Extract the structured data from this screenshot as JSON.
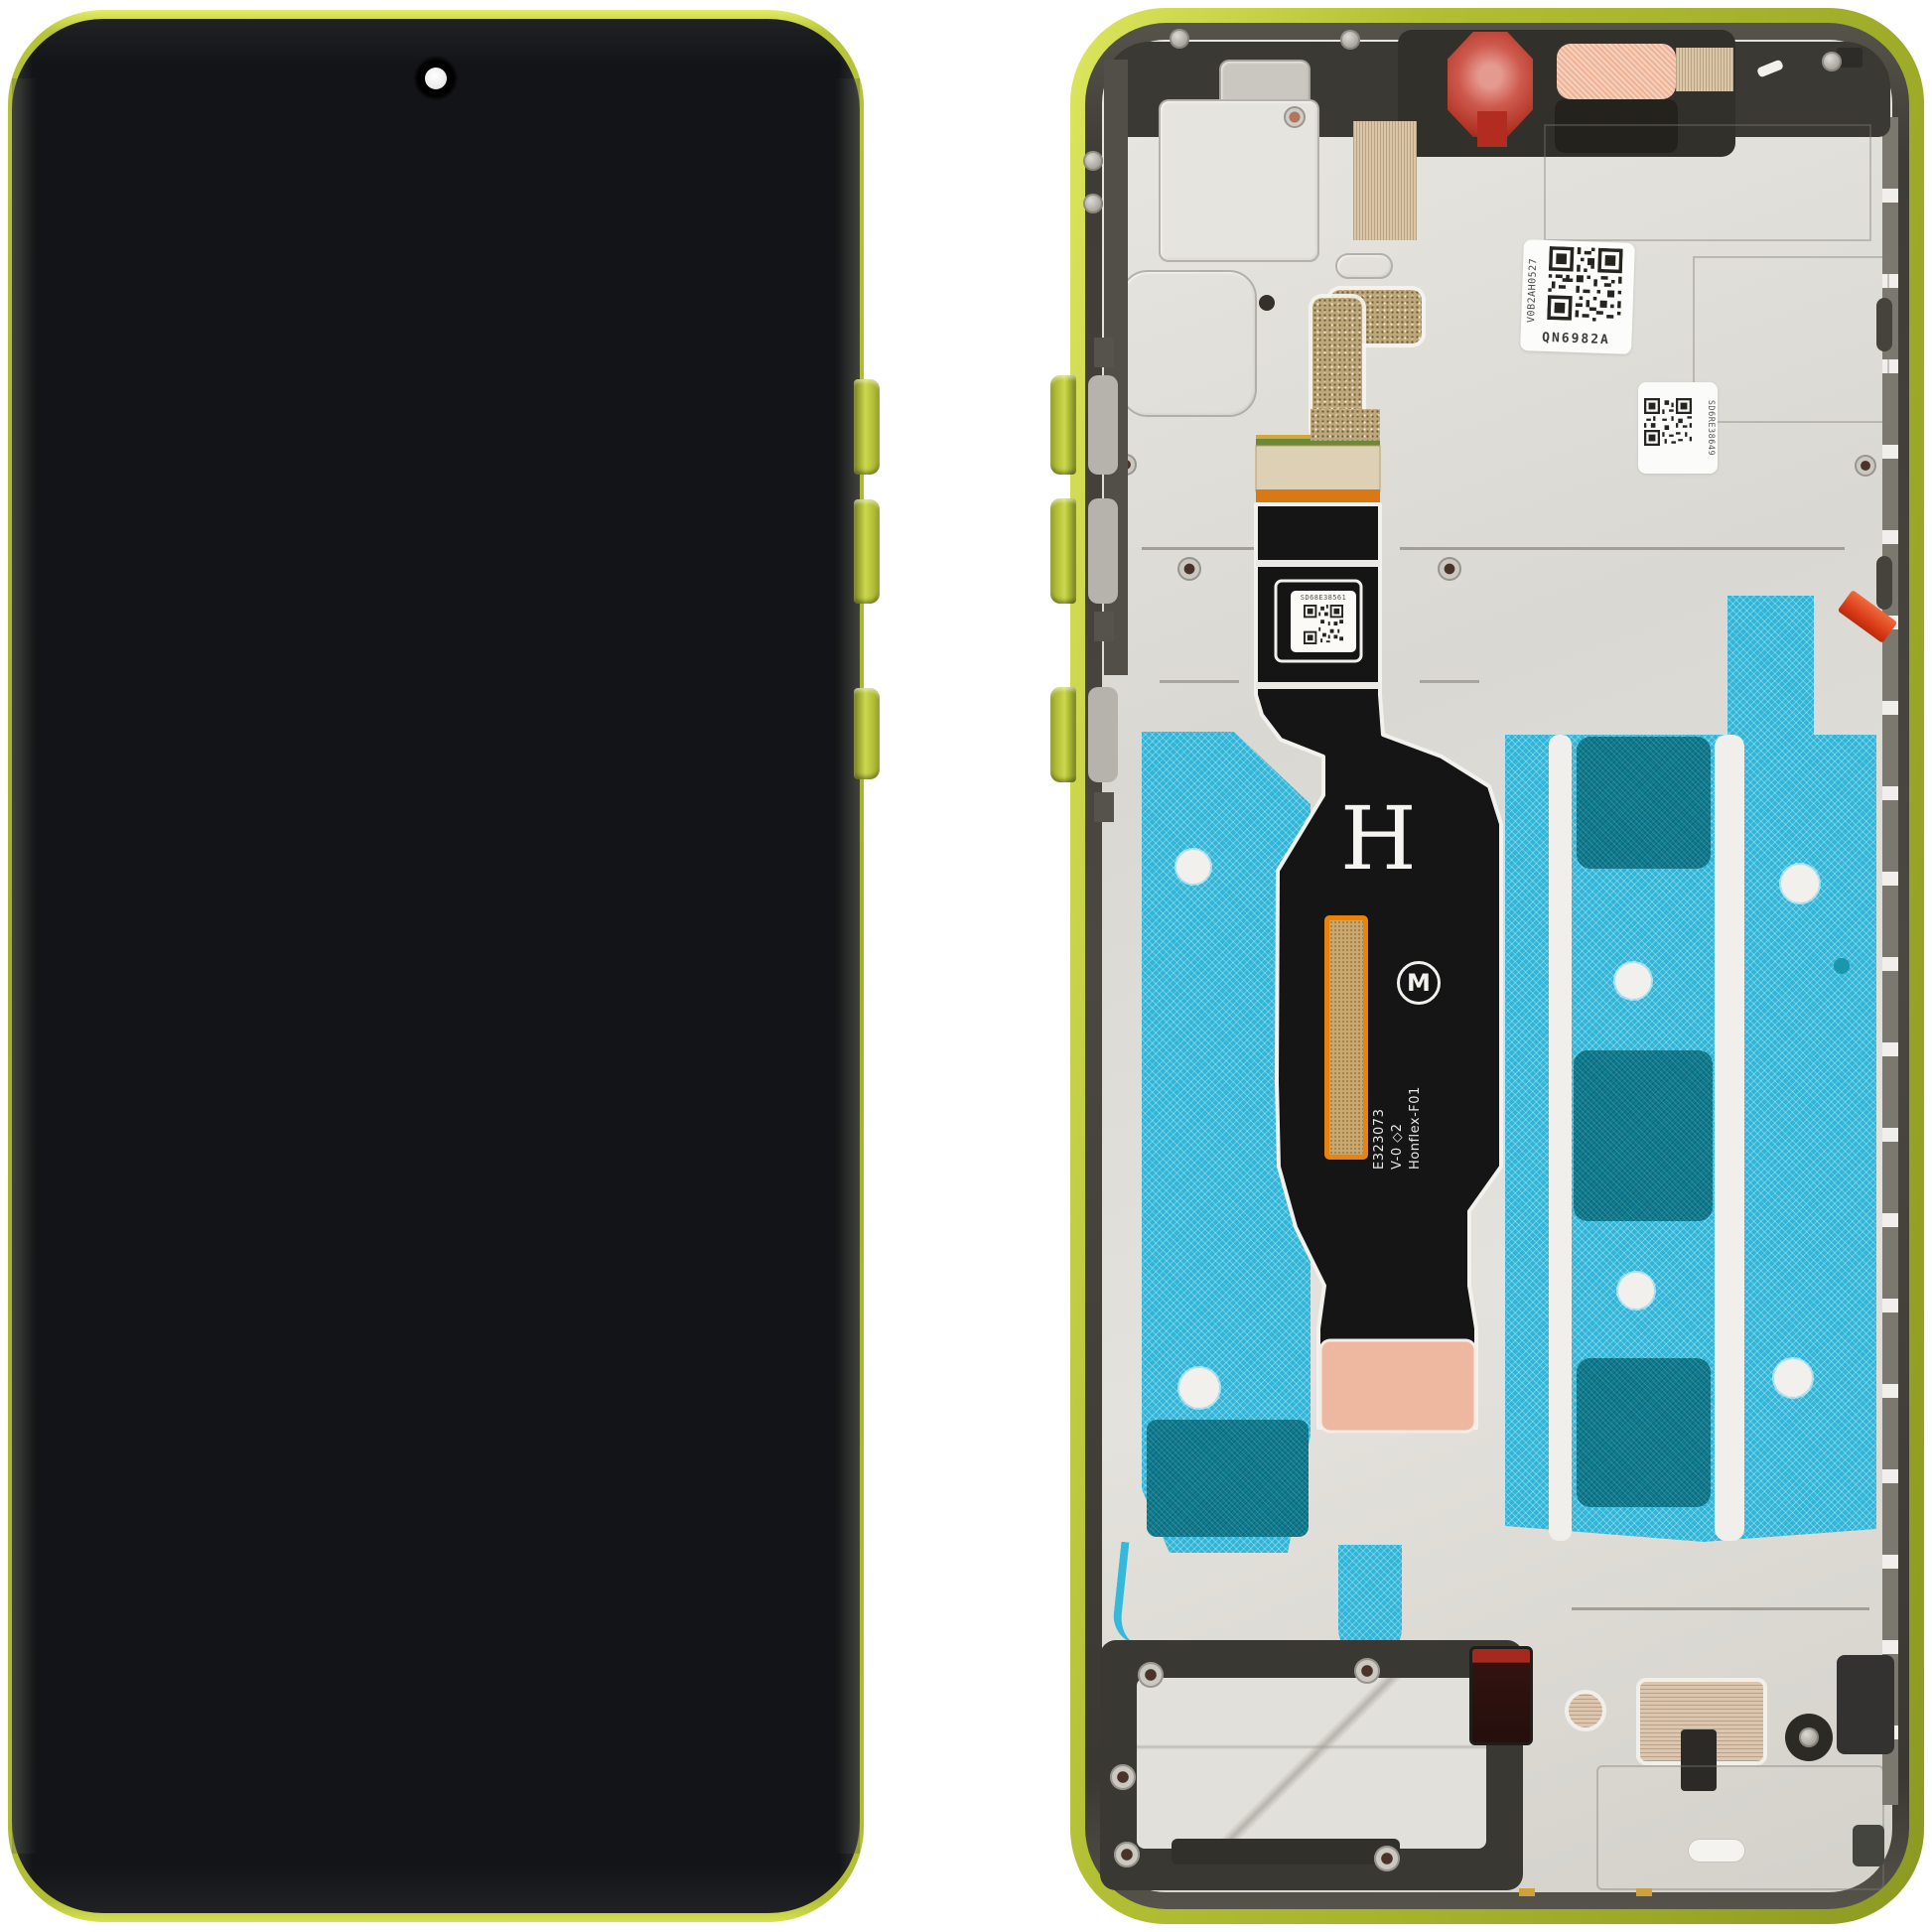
{
  "scene": {
    "subject": "Smartphone display assembly, front view and inner view",
    "frame_color_name": "lime yellow"
  },
  "colors": {
    "background": "#ffffff",
    "frame_lime": "#b7c437",
    "frame_lime_light": "#e6ef6e",
    "frame_lime_dark": "#7e8b1d",
    "screen_black": "#131417",
    "inner_rim_gray": "#4a4840",
    "plate_silver": "#dedcd6",
    "gasket_black": "#38362f",
    "adhesive_cyan": "#2fb5d7",
    "adhesive_teal_dark": "#0e7a8e",
    "flex_black": "#151515",
    "flex_outline_white": "#f2f1ed",
    "gold_pad": "#c9a870",
    "pad_border_orange": "#e8830e",
    "connector_copper": "#edb7a0",
    "pull_tab_red": "#e8421d",
    "camera_film_red": "#c24237",
    "earpiece_mesh_pink": "#efb295",
    "speckle_gold": "#bda87c"
  },
  "front_view": {
    "camera_name": "punch-hole selfie camera"
  },
  "inner_view": {
    "labels": {
      "qr_main_vertical": "V0B2AH0527",
      "qr_main_code": "QN6982A",
      "qr_plate_code": "SD6RE38649",
      "qr_flex_code": "SD68E38561"
    },
    "flex_markings": {
      "h_mark": "H",
      "line1": "E323073",
      "line2": "V-0 ◇2",
      "line3": "Honflex-F01",
      "brand_glyph": "M"
    }
  }
}
